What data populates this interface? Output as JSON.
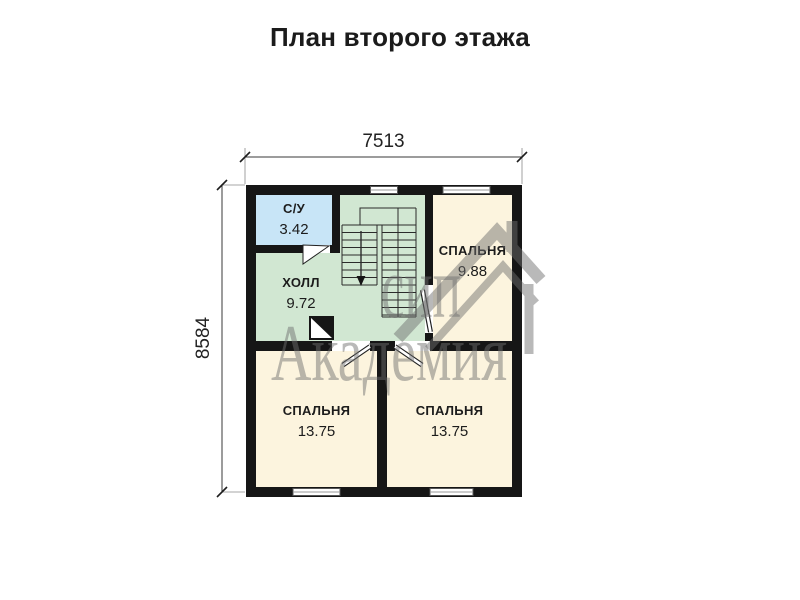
{
  "title": "План второго этажа",
  "dimensions": {
    "top": "7513",
    "left": "8584"
  },
  "rooms": {
    "bathroom": {
      "name": "С/У",
      "area": "3.42"
    },
    "hall": {
      "name": "ХОЛЛ",
      "area": "9.72"
    },
    "bedroom_top": {
      "name": "СПАЛЬНЯ",
      "area": "9.88"
    },
    "bedroom_left": {
      "name": "СПАЛЬНЯ",
      "area": "13.75"
    },
    "bedroom_right": {
      "name": "СПАЛЬНЯ",
      "area": "13.75"
    }
  },
  "watermark": {
    "word1": "сип",
    "word2": "Академия",
    "logo": "house-logo-icon"
  },
  "icons": {
    "stairs_arrow": "stairs-down-arrow-icon",
    "shaft": "ventilation-shaft-icon",
    "windows": "window-symbol",
    "doors": "door-symbol"
  },
  "colors": {
    "wall": "#161616",
    "bathroom_fill": "#c8e5f7",
    "hall_fill": "#d1e7d2",
    "bedroom_fill": "#fcf4de",
    "dimension_line": "#3a3a3a",
    "watermark_gray": "#6f6f6f"
  }
}
